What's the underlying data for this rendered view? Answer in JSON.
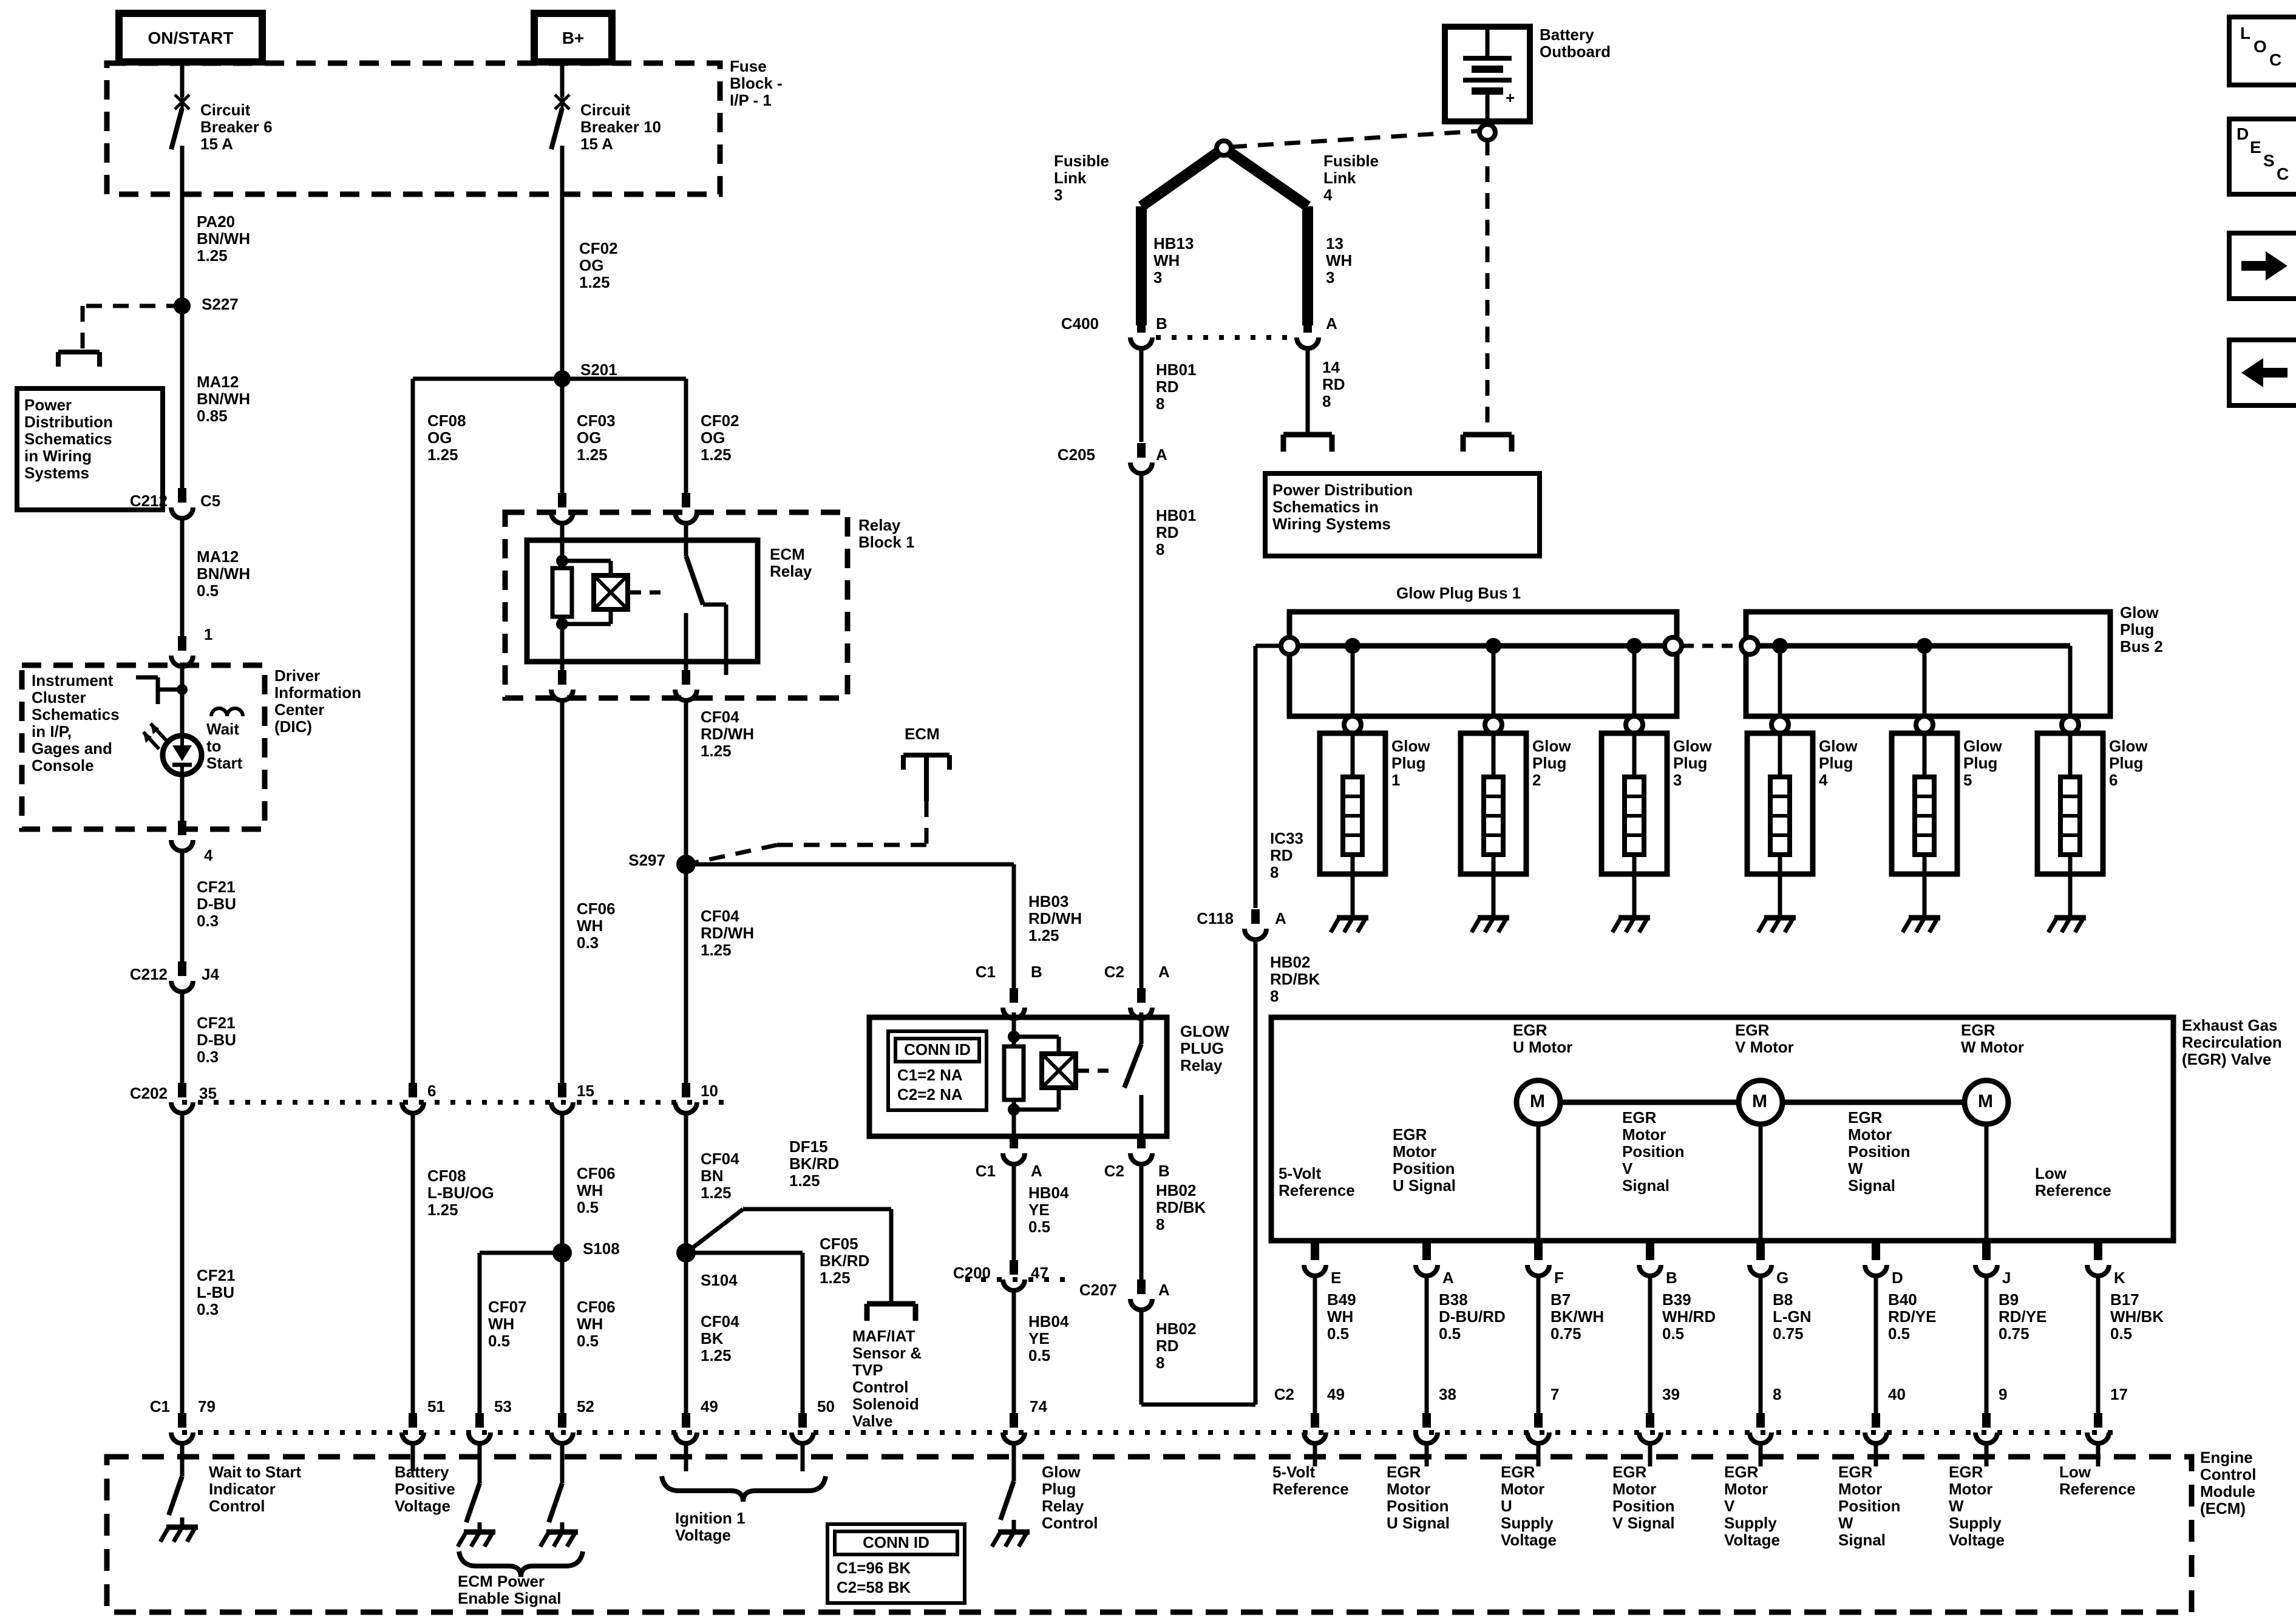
{
  "colors": {
    "ink": "#000000",
    "paper": "#ffffff"
  },
  "header": {
    "on_start": "ON/START",
    "b_plus": "B+"
  },
  "toolbar": {
    "loc": [
      "L",
      "O",
      "C"
    ],
    "desc": [
      "D",
      "E",
      "S",
      "C"
    ]
  },
  "fuse_block": {
    "title": "Fuse\nBlock -\nI/P - 1",
    "cb6": "Circuit\nBreaker 6\n15 A",
    "cb10": "Circuit\nBreaker 10\n15 A"
  },
  "left": {
    "pa20": "PA20\nBN/WH\n1.25",
    "s227": "S227",
    "power_dist": "Power\nDistribution\nSchematics\nin Wiring\nSystems",
    "ma12_085": "MA12\nBN/WH\n0.85",
    "c212a": "C212",
    "c5": "C5",
    "ma12_05": "MA12\nBN/WH\n0.5",
    "pin1": "1",
    "instrument": "Instrument\nCluster\nSchematics\nin I/P,\nGages and\nConsole",
    "wait_to_start": "Wait\nto\nStart",
    "dic": "Driver\nInformation\nCenter\n(DIC)",
    "pin4": "4",
    "cf21_a": "CF21\nD-BU\n0.3",
    "c212b": "C212",
    "j4": "J4",
    "cf21_b": "CF21\nD-BU\n0.3",
    "c202": "C202",
    "pin35": "35",
    "cf21_c": "CF21\nL-BU\n0.3"
  },
  "center": {
    "cf02_top": "CF02\nOG\n1.25",
    "s201": "S201",
    "cf08": "CF08\nOG\n1.25",
    "cf03": "CF03\nOG\n1.25",
    "cf02": "CF02\nOG\n1.25",
    "relay_block": "Relay\nBlock 1",
    "ecm_relay": "ECM\nRelay",
    "cf04_a": "CF04\nRD/WH\n1.25",
    "ecm_pointer": "ECM",
    "s297": "S297",
    "cf06_03": "CF06\nWH\n0.3",
    "cf04_b": "CF04\nRD/WH\n1.25",
    "hb03": "HB03\nRD/WH\n1.25",
    "pin6": "6",
    "pin15": "15",
    "pin10": "10",
    "cf08_lbuog": "CF08\nL-BU/OG\n1.25",
    "cf06_05a": "CF06\nWH\n0.5",
    "s108": "S108",
    "s104": "S104",
    "cf07": "CF07\nWH\n0.5",
    "cf06_05b": "CF06\nWH\n0.5",
    "cf04_bn": "CF04\nBN\n1.25",
    "df15": "DF15\nBK/RD\n1.25",
    "cf05": "CF05\nBK/RD\n1.25",
    "cf04_bk": "CF04\nBK\n1.25",
    "maf": "MAF/IAT\nSensor &\nTVP\nControl\nSolenoid\nValve"
  },
  "battery": {
    "label": "Battery\nOutboard",
    "plus": "+"
  },
  "fusible": {
    "link3": "Fusible\nLink\n3",
    "link4": "Fusible\nLink\n4",
    "hb13": "HB13\nWH\n3",
    "w13": "13\nWH\n3",
    "c400": "C400",
    "b": "B",
    "a": "A",
    "hb01_a": "HB01\nRD\n8",
    "rd14": "14\nRD\n8",
    "c205": "C205",
    "c205_pin": "A",
    "hb01_b": "HB01\nRD\n8",
    "power_dist": "Power Distribution\nSchematics in\nWiring Systems"
  },
  "glow_relay": {
    "title": "GLOW\nPLUG\nRelay",
    "conn_id_title": "CONN ID",
    "conn_id_rows": "C1=2 NA\nC2=2 NA",
    "c1_top": "C1",
    "c1_top_pin": "B",
    "c2_top": "C2",
    "c2_top_pin": "A",
    "c1_bot": "C1",
    "c1_bot_pin": "A",
    "c2_bot": "C2",
    "c2_bot_pin": "B",
    "hb04_a": "HB04\nYE\n0.5",
    "c200": "C200",
    "pin47": "47",
    "hb04_b": "HB04\nYE\n0.5",
    "hb02_a": "HB02\nRD/BK\n8",
    "c207": "C207",
    "c207_pin": "A",
    "hb02_b": "HB02\nRD\n8"
  },
  "glow_bus": {
    "bus1": "Glow Plug Bus 1",
    "bus2": "Glow\nPlug\nBus 2",
    "ic33": "IC33\nRD\n8",
    "c118": "C118",
    "c118_pin": "A",
    "hb02": "HB02\nRD/BK\n8",
    "plugs": [
      "Glow\nPlug\n1",
      "Glow\nPlug\n2",
      "Glow\nPlug\n3",
      "Glow\nPlug\n4",
      "Glow\nPlug\n5",
      "Glow\nPlug\n6"
    ]
  },
  "egr": {
    "title": "Exhaust Gas\nRecirculation\n(EGR) Valve",
    "u_motor": "EGR\nU Motor",
    "v_motor": "EGR\nV Motor",
    "w_motor": "EGR\nW Motor",
    "m": "M",
    "five_volt": "5-Volt\nReference",
    "pos_u": "EGR\nMotor\nPosition\nU Signal",
    "pos_v": "EGR\nMotor\nPosition\nV\nSignal",
    "pos_w": "EGR\nMotor\nPosition\nW\nSignal",
    "low_ref": "Low\nReference",
    "pins": [
      {
        "letter": "E",
        "num": "49",
        "wire": "B49\nWH\n0.5",
        "ecm": "5-Volt\nReference"
      },
      {
        "letter": "A",
        "num": "38",
        "wire": "B38\nD-BU/RD\n0.5",
        "ecm": "EGR\nMotor\nPosition\nU Signal"
      },
      {
        "letter": "F",
        "num": "7",
        "wire": "B7\nBK/WH\n0.75",
        "ecm": "EGR\nMotor\nU\nSupply\nVoltage"
      },
      {
        "letter": "B",
        "num": "39",
        "wire": "B39\nWH/RD\n0.5",
        "ecm": "EGR\nMotor\nPosition\nV Signal"
      },
      {
        "letter": "G",
        "num": "8",
        "wire": "B8\nL-GN\n0.75",
        "ecm": "EGR\nMotor\nV\nSupply\nVoltage"
      },
      {
        "letter": "D",
        "num": "40",
        "wire": "B40\nRD/YE\n0.5",
        "ecm": "EGR\nMotor\nPosition\nW\nSignal"
      },
      {
        "letter": "J",
        "num": "9",
        "wire": "B9\nRD/YE\n0.75",
        "ecm": "EGR\nMotor\nW\nSupply\nVoltage"
      },
      {
        "letter": "K",
        "num": "17",
        "wire": "B17\nWH/BK\n0.5",
        "ecm": "Low\nReference"
      }
    ]
  },
  "ecm": {
    "c1": "C1",
    "pin79": "79",
    "pin51": "51",
    "pin53": "53",
    "pin52": "52",
    "pin49": "49",
    "pin50": "50",
    "pin74": "74",
    "c2": "C2",
    "wait_ctl": "Wait to Start\nIndicator\nControl",
    "batt_pos": "Battery\nPositive\nVoltage",
    "ecm_power": "ECM Power\nEnable Signal",
    "ignition": "Ignition 1\nVoltage",
    "conn_id_title": "CONN ID",
    "conn_id_rows": "C1=96 BK\nC2=58 BK",
    "glow_ctl": "Glow\nPlug\nRelay\nControl",
    "module": "Engine\nControl\nModule\n(ECM)"
  }
}
